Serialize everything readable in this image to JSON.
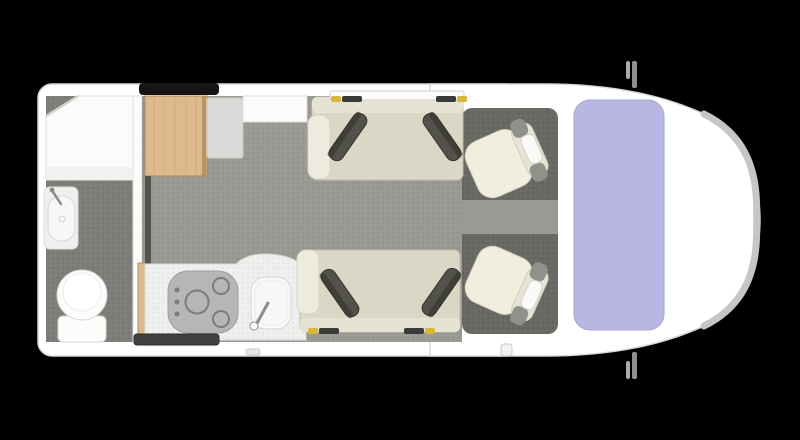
{
  "canvas": {
    "width": 800,
    "height": 440,
    "background": "#000000"
  },
  "scene": {
    "subject": "motorhome-floorplan-top-view",
    "fixtures": [
      "shower",
      "bathroom-sink",
      "toilet",
      "dinette-table",
      "side-cabinet",
      "kitchen-hob",
      "kitchen-sink",
      "travel-bench-top",
      "travel-bench-bottom",
      "cab-seat-top",
      "cab-seat-bottom",
      "windshield",
      "side-mirrors"
    ]
  },
  "palette": {
    "background": "#000000",
    "bodyWhite": "#ffffff",
    "bodyEdge": "#d8d8da",
    "bumperSilver": "#c6c6ca",
    "windshield": "#b8b6e2",
    "windshieldEdge": "#a6a4cf",
    "mirrorGray": "#8f8f91",
    "mirrorLight": "#ababad",
    "floorMain": "#9a9a94",
    "floorBath": "#7d7d79",
    "floorCab": "#696963",
    "floorCabStrip": "#a19f9b",
    "wallWhite": "#fbfbfa",
    "panelStroke": "#dededc",
    "wood": "#dcba8d",
    "woodEdge": "#b08a57",
    "pedestalDark": "#55534d",
    "cabinetGray": "#d9d9d7",
    "counterWhite": "#efefed",
    "stoveGray": "#b6b6b4",
    "stoveRing": "#7c7c7a",
    "stoveStroke": "#9d9d9b",
    "sinkWhite": "#f7f7f5",
    "basinStroke": "#d6d6d4",
    "metalGray": "#8d8d8b",
    "toiletWhite": "#fcfcfa",
    "toiletInner": "#ffffff",
    "toiletInnerStroke": "#ebebe9",
    "showerBench": "#f1f1ef",
    "showerStroke": "#cfcfcd",
    "benchCream": "#dbd7c6",
    "benchLight": "#e7e3d2",
    "benchEdge": "#c3bfac",
    "armWhite": "#edebdd",
    "armStroke": "#d6d3c3",
    "cushionDark": "#52514a",
    "cushionDarker": "#34332d",
    "seatCream": "#f1eee0",
    "seatBack": "#e7e4d4",
    "seatEdge": "#d3cfbf",
    "seatFrame": "#91918b",
    "headrestWhite": "#fafaf8",
    "headrestStroke": "#d2d2d0",
    "beltYellow": "#d8b637",
    "beltDark": "#3a3a38",
    "windowBlack": "#151515",
    "windowDark": "#414141",
    "windowDarkStroke": "#2c2c2a",
    "nubLight": "#e6e6e4",
    "nubStroke": "#c9c9c7",
    "stepWhite": "#f3f3f1"
  }
}
